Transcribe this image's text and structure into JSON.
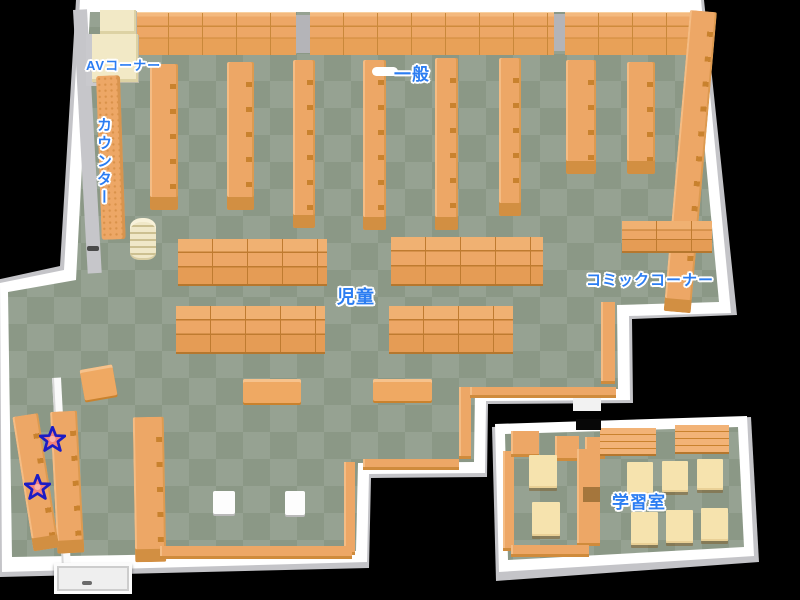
{
  "map": {
    "labels": {
      "av_corner": "AVコーナー",
      "general": "一般",
      "counter": "カウンター",
      "children": "児童",
      "comic_corner": "コミックコーナー",
      "study_room": "学習室"
    },
    "markers": {
      "star_count": 2
    },
    "colors": {
      "background": "#000000",
      "floor_light": "#96a292",
      "floor_dark": "#8b9886",
      "wall_white": "#ffffff",
      "wall_gray": "#c6c6ca",
      "shelf_orange": "#eda766",
      "shelf_shadow": "#c9822e",
      "av_shelf_cream": "#f2e9c6",
      "desk_cream": "#f6e3ae",
      "label_blue": "#2b7df2",
      "star_fill": "#f2837b",
      "star_outline": "#1c1cc4"
    }
  }
}
